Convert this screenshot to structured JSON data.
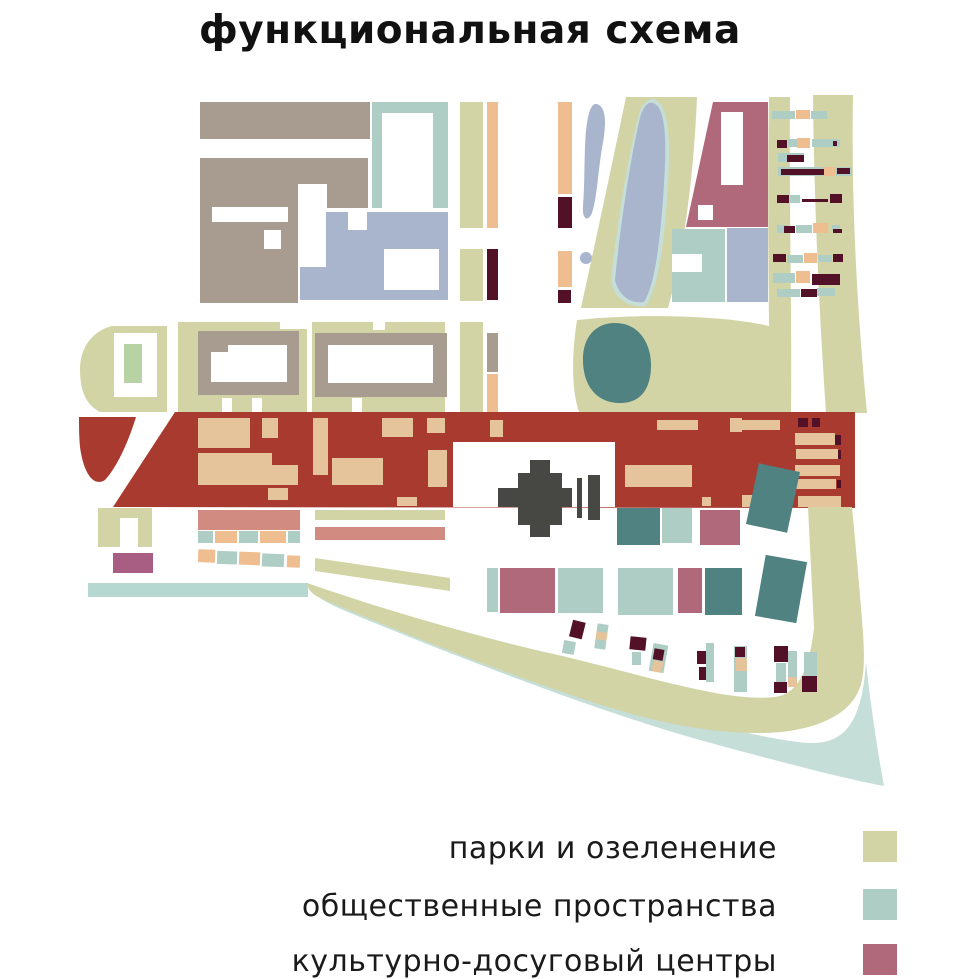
{
  "title": "функциональная схема",
  "legend": {
    "items": [
      {
        "label": "парки и озеленение",
        "color": "#d2d4a6"
      },
      {
        "label": "общественные пространства",
        "color": "#aecdc5"
      },
      {
        "label": "культурно-досуговый центры",
        "color": "#b0697a"
      }
    ]
  },
  "colors": {
    "red": "#a93a30",
    "park": "#d2d4a6",
    "teal": "#aecdc5",
    "tealroad": "#b5d8d1",
    "tealpale": "#c5ded8",
    "darkteal": "#4f8280",
    "mauve": "#b0697a",
    "purple": "#a85e82",
    "salmon": "#d28b80",
    "taupe": "#a89c90",
    "bluegray": "#a8b5cd",
    "orange": "#eebe90",
    "tan": "#e5c49c",
    "maroon": "#521126",
    "green2": "#b7d3a3",
    "dark": "#474744"
  }
}
